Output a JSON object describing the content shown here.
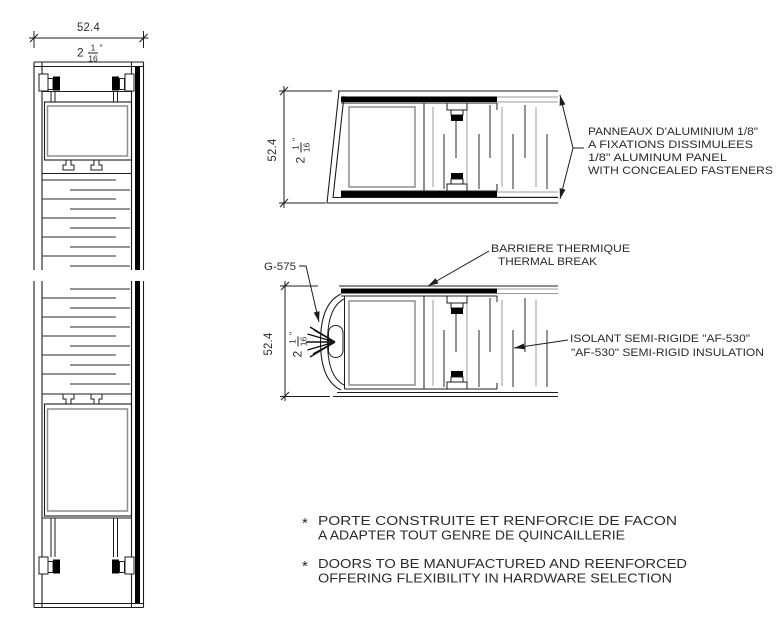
{
  "drawing_type": "door-section-detail",
  "colors": {
    "ink": "#1d1d1d",
    "gray_line": "#9b9b9b",
    "panel_fill": "#000000",
    "window_stroke": "#8d8d8d",
    "text": "#2b2b2b",
    "background": "#ffffff"
  },
  "sections": {
    "left_profile": {
      "dim_mm": "52.4",
      "dim_in": {
        "whole": "2",
        "num": "1",
        "den": "16",
        "unit": "\""
      }
    },
    "top_panel_section": {
      "dim_mm": "52.4",
      "dim_in": {
        "whole": "2",
        "num": "1",
        "den": "16",
        "unit": "\""
      },
      "panel_callout": {
        "lines": [
          "PANNEAUX D'ALUMINIUM 1/8\"",
          "A FIXATIONS DISSIMULEES",
          "1/8\" ALUMINUM PANEL",
          "WITH CONCEALED FASTENERS"
        ]
      }
    },
    "thermal_break_section": {
      "dim_mm": "52.4",
      "dim_in": {
        "whole": "2",
        "num": "1",
        "den": "16",
        "unit": "\""
      },
      "gasket_label": "G-575",
      "thermal_callout": {
        "lines": [
          "BARRIERE THERMIQUE",
          "THERMAL BREAK"
        ]
      },
      "insulation_callout": {
        "lines": [
          "ISOLANT SEMI-RIGIDE \"AF-530\"",
          "\"AF-530\" SEMI-RIGID INSULATION"
        ]
      }
    }
  },
  "notes": [
    {
      "bullet": "*",
      "lines": [
        "PORTE CONSTRUITE ET RENFORCIE DE FACON",
        "A ADAPTER TOUT GENRE DE QUINCAILLERIE"
      ]
    },
    {
      "bullet": "*",
      "lines": [
        "DOORS TO BE MANUFACTURED AND REENFORCED",
        "OFFERING FLEXIBILITY IN HARDWARE SELECTION"
      ]
    }
  ]
}
